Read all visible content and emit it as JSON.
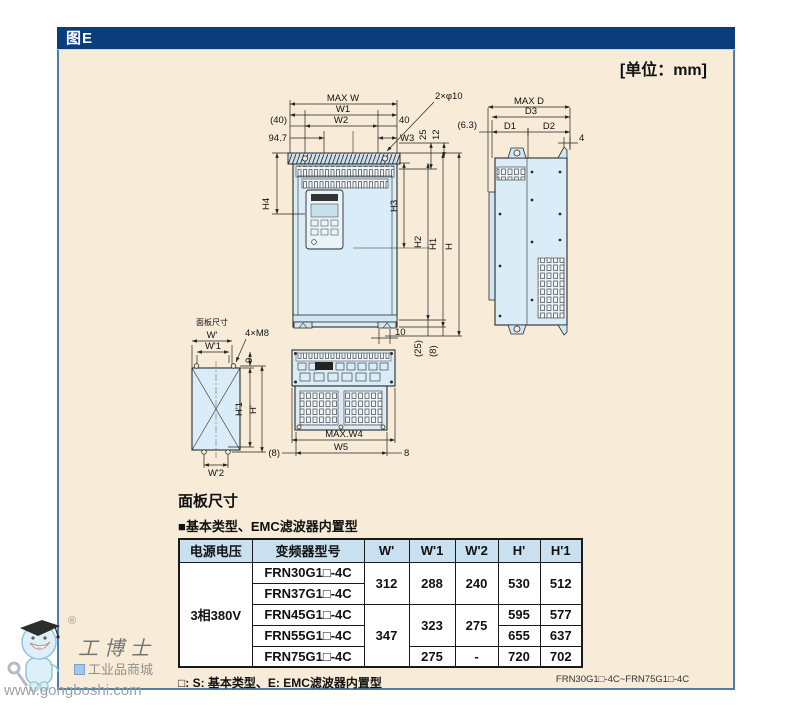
{
  "header": {
    "figure_label": "图E",
    "unit_label": "[单位：mm]"
  },
  "drawing": {
    "front_view": {
      "max_w": "MAX W",
      "w1": "W1",
      "w2": "W2",
      "left_offset": "(40)",
      "keypad_offset": "94.7",
      "right_offset": "40",
      "w3": "W3",
      "top_25": "25",
      "top_12": "12",
      "hole_callout": "2×φ10",
      "h4": "H4",
      "h3": "H3",
      "h2": "H2",
      "h1": "H1",
      "h": "H",
      "bottom_10": "10",
      "bottom_25": "(25)",
      "bottom_8": "(8)"
    },
    "side_view": {
      "max_d": "MAX D",
      "d3": "D3",
      "d1": "D1",
      "d2": "D2",
      "left_offset": "(6.3)",
      "hook_4": "4"
    },
    "bottom_view": {
      "max_w4": "MAX.W4",
      "w5": "W5",
      "left_8": "(8)",
      "right_8": "8"
    },
    "panel_cutout": {
      "caption": "面板尺寸",
      "w": "W'",
      "w1": "W'1",
      "w2": "W'2",
      "h": "H'",
      "h1": "H'1",
      "top_9": "9",
      "hole_callout": "4×M8"
    }
  },
  "table_section": {
    "title": "面板尺寸",
    "subtitle": "■基本类型、EMC滤波器内置型",
    "columns": [
      "电源电压",
      "变频器型号",
      "W'",
      "W'1",
      "W'2",
      "H'",
      "H'1"
    ],
    "voltage": "3相380V",
    "models": [
      "FRN30G1□-4C",
      "FRN37G1□-4C",
      "FRN45G1□-4C",
      "FRN55G1□-4C",
      "FRN75G1□-4C"
    ],
    "values": {
      "w_group1": "312",
      "w_group2": "347",
      "w1_group1": "288",
      "w1_group2": "323",
      "w1_row5": "275",
      "w2_group1": "240",
      "w2_group2": "275",
      "w2_row5": "-",
      "h_group1": "530",
      "h_row3": "595",
      "h_row4": "655",
      "h_row5": "720",
      "h1_group1": "512",
      "h1_row3": "577",
      "h1_row4": "637",
      "h1_row5": "702"
    },
    "footnote": "□: S: 基本类型、E: EMC滤波器内置型"
  },
  "footer": {
    "model_range": "FRN30G1□-4C~FRN75G1□-4C"
  },
  "watermark": {
    "registered": "®",
    "brand": "工博士",
    "tagline": "工业品商城",
    "url": "www.gongboshi.com"
  },
  "colors": {
    "titlebar_bg": "#0b3d7d",
    "content_bg": "#f8ecd8",
    "frame_border": "#4d7fae",
    "table_header_bg": "#c9e0f1",
    "drawing_fill": "#d9ecf7"
  }
}
